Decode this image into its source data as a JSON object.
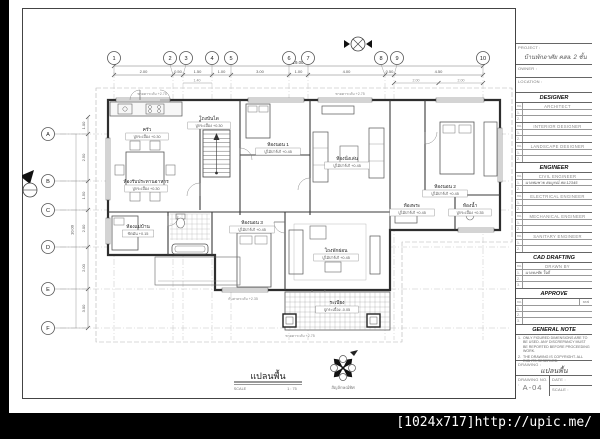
{
  "watermark": {
    "text": "[1024x717]http://upic.me/"
  },
  "titleblock": {
    "project_label": "PROJECT :",
    "project_name": "บ้านพักอาศัย คสล. 2 ชั้น",
    "owner_label": "OWNER :",
    "location_label": "LOCATION :",
    "sections": [
      {
        "header": "DESIGNER",
        "groups": [
          {
            "title": "ARCHITECT",
            "rows": [
              "",
              ""
            ]
          },
          {
            "title": "INTERIOR DESIGNER",
            "rows": [
              "",
              ""
            ]
          },
          {
            "title": "LANDSCAPE DESIGNER",
            "rows": [
              "",
              ""
            ]
          }
        ]
      },
      {
        "header": "ENGINEER",
        "groups": [
          {
            "title": "CIVIL ENGINEER",
            "rows": [
              "นายสมชาย สมบูรณ์  สย.12345",
              ""
            ]
          },
          {
            "title": "ELECTRICAL ENGINEER",
            "rows": [
              "",
              ""
            ]
          },
          {
            "title": "MECHANICAL ENGINEER",
            "rows": [
              "",
              ""
            ]
          },
          {
            "title": "SANITARY ENGINEER",
            "rows": [
              "",
              ""
            ]
          }
        ]
      },
      {
        "header": "CAD DRAFTING",
        "groups": [
          {
            "title": "DRAWN BY",
            "rows": [
              "นายธงชัย ใจดี",
              "",
              ""
            ]
          }
        ]
      },
      {
        "header": "APPROVE",
        "groups": [
          {
            "title": "",
            "seal": "seal",
            "rows": [
              "",
              "",
              ""
            ]
          }
        ]
      }
    ],
    "general_note": {
      "header": "GENERAL NOTE",
      "items": [
        "ONLY FIGURED DIMENSIONS ARE TO BE USED. ANY DISCREPANCY MUST BE REPORTED BEFORE PROCEEDING WORK.",
        "THE DRAWING IS COPYRIGHT. ALL RIGHTS RESERVED."
      ]
    },
    "drawing_label": "DRAWING :",
    "drawing_name": "แปลนพื้น",
    "drawing_no_label": "DRAWING NO. :",
    "drawing_no": "A-04",
    "date_label": "DATE :",
    "scale_label": "SCALE :"
  },
  "plan": {
    "grid": {
      "cols": [
        "1",
        "2",
        "3",
        "4",
        "5",
        "6",
        "7",
        "8",
        "9",
        "10"
      ],
      "rows": [
        "A",
        "B",
        "C",
        "D",
        "E",
        "F"
      ]
    },
    "dims": {
      "top": [
        "2.00",
        "0.50",
        "1.50",
        "1.00",
        "3.00",
        "1.00",
        "4.00",
        "0.50",
        "4.50"
      ],
      "top_overall": "19.00",
      "top_sub": [
        "2.00",
        "2.00",
        "1.40"
      ],
      "left": [
        "1.00",
        "2.50",
        "1.50",
        "2.00",
        "2.00",
        "3.00"
      ],
      "left_overall": "10.00"
    },
    "rooms": [
      {
        "name": "ครัว",
        "finish": "ปูกระเบื้อง +0.30"
      },
      {
        "name": "ห้องรับประทานอาหาร",
        "finish": "ปูกระเบื้อง +0.30"
      },
      {
        "name": "โถงบันได",
        "finish": "ปูกระเบื้อง +0.30"
      },
      {
        "name": "ห้องนอน 1",
        "finish": "ปูไม้ปาร์เก้ +0.45"
      },
      {
        "name": "ห้องนั่งเล่น",
        "finish": "ปูไม้ปาร์เก้ +0.45"
      },
      {
        "name": "ห้องนอน 2",
        "finish": "ปูไม้ปาร์เก้ +0.45"
      },
      {
        "name": "ห้องพระ",
        "finish": "ปูไม้ปาร์เก้ +0.45"
      },
      {
        "name": "ห้องน้ำ",
        "finish": "ปูกระเบื้อง +0.35"
      },
      {
        "name": "ห้องแม่บ้าน",
        "finish": "ขัดมัน +0.15"
      },
      {
        "name": "ห้องนอน 3",
        "finish": "ปูไม้ปาร์เก้ +0.45"
      },
      {
        "name": "โถงพักผ่อน",
        "finish": "ปูไม้ปาร์เก้ +0.45"
      },
      {
        "name": "ระเบียง",
        "finish": "ปูกระเบื้อง -0.05"
      }
    ],
    "annotations": [
      "ชายคาระดับ +2.75",
      "ชายคาระดับ +2.75",
      "ชายคาระดับ +2.75",
      "กันสาดระดับ +2.35"
    ],
    "title": {
      "name": "แปลนพื้น",
      "scale_label": "SCALE",
      "scale_value": "1 : 75"
    },
    "compass_label": "สัญลักษณ์ทิศ"
  }
}
